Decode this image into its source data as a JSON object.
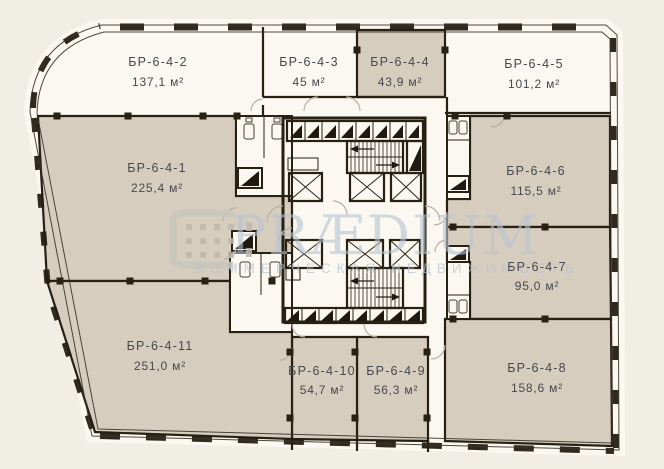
{
  "units": [
    {
      "name": "БР-6-4-1",
      "area": "225,4 м²"
    },
    {
      "name": "БР-6-4-2",
      "area": "137,1 м²"
    },
    {
      "name": "БР-6-4-3",
      "area": "45 м²"
    },
    {
      "name": "БР-6-4-4",
      "area": "43,9 м²"
    },
    {
      "name": "БР-6-4-5",
      "area": "101,2 м²"
    },
    {
      "name": "БР-6-4-6",
      "area": "115,5 м²"
    },
    {
      "name": "БР-6-4-7",
      "area": "95,0 м²"
    },
    {
      "name": "БР-6-4-8",
      "area": "158,6 м²"
    },
    {
      "name": "БР-6-4-9",
      "area": "56,3 м²"
    },
    {
      "name": "БР-6-4-10",
      "area": "54,7 м²"
    },
    {
      "name": "БР-6-4-11",
      "area": "251,0 м²"
    }
  ],
  "watermark": {
    "brand": "PRÆDIUM",
    "tagline": "КОММЕРЧЕСКАЯ НЕДВИЖИМОСТЬ"
  },
  "colors": {
    "background": "#f1eee5",
    "interior": "#faf8f0",
    "unit_fill": "#d7cdbe",
    "wall": "#272013",
    "watermark": "#b7c3d2"
  }
}
